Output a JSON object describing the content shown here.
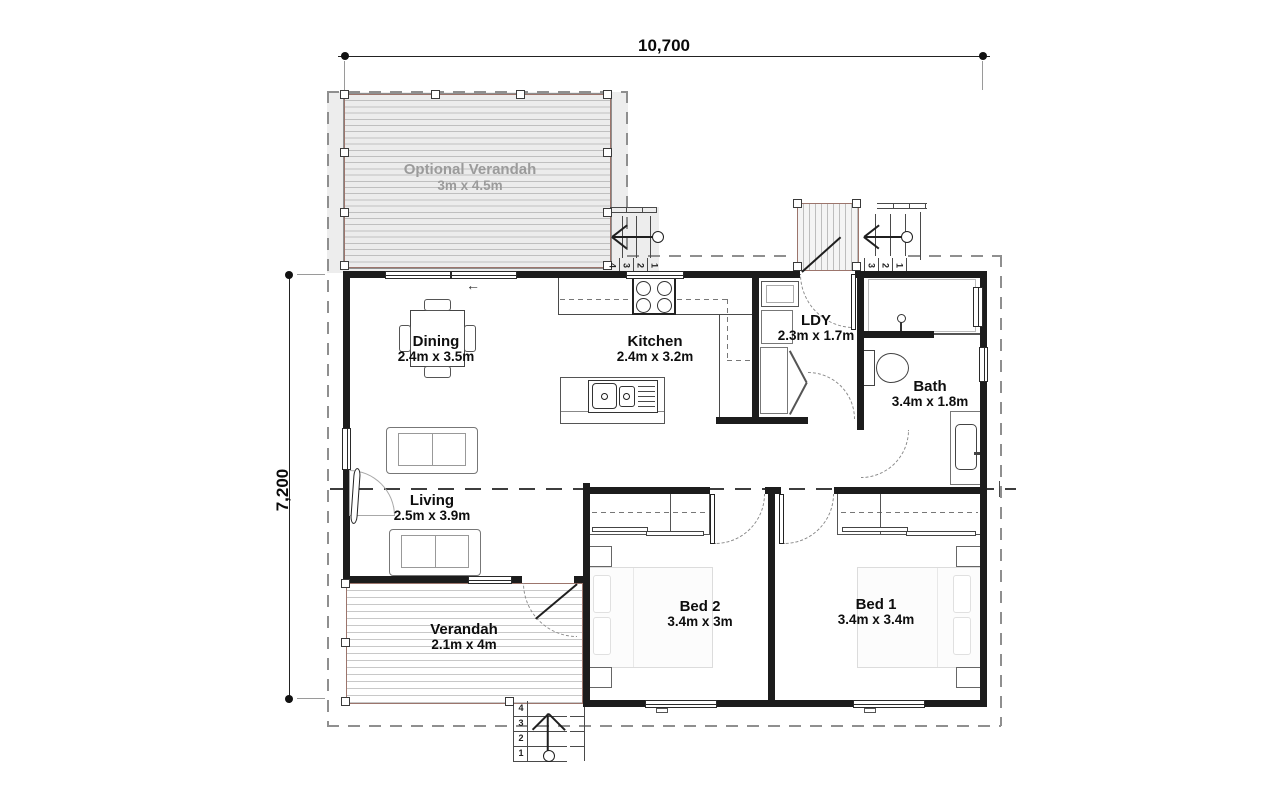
{
  "plan": {
    "dims": {
      "width_label": "10,700",
      "height_label": "7,200"
    },
    "rooms": {
      "optional_verandah": {
        "name": "Optional Verandah",
        "size": "3m x 4.5m"
      },
      "dining": {
        "name": "Dining",
        "size": "2.4m x 3.5m"
      },
      "kitchen": {
        "name": "Kitchen",
        "size": "2.4m x 3.2m"
      },
      "ldy": {
        "name": "LDY",
        "size": "2.3m x 1.7m"
      },
      "bath": {
        "name": "Bath",
        "size": "3.4m x 1.8m"
      },
      "living": {
        "name": "Living",
        "size": "2.5m x 3.9m"
      },
      "bed2": {
        "name": "Bed 2",
        "size": "3.4m x 3m"
      },
      "bed1": {
        "name": "Bed 1",
        "size": "3.4m x 3.4m"
      },
      "verandah": {
        "name": "Verandah",
        "size": "2.1m x 4m"
      }
    },
    "steps": {
      "kitchen": [
        "4",
        "3",
        "2",
        "1"
      ],
      "entry": [
        "3",
        "2",
        "1"
      ],
      "verandah": [
        "4",
        "3",
        "2",
        "1"
      ]
    },
    "icons": {
      "slide_arrow": "←"
    },
    "colors": {
      "wall": "#1c1c1c",
      "deck_trim": "#9c756c",
      "zone": "#ededed",
      "boundary": "#8f8f8f"
    }
  }
}
